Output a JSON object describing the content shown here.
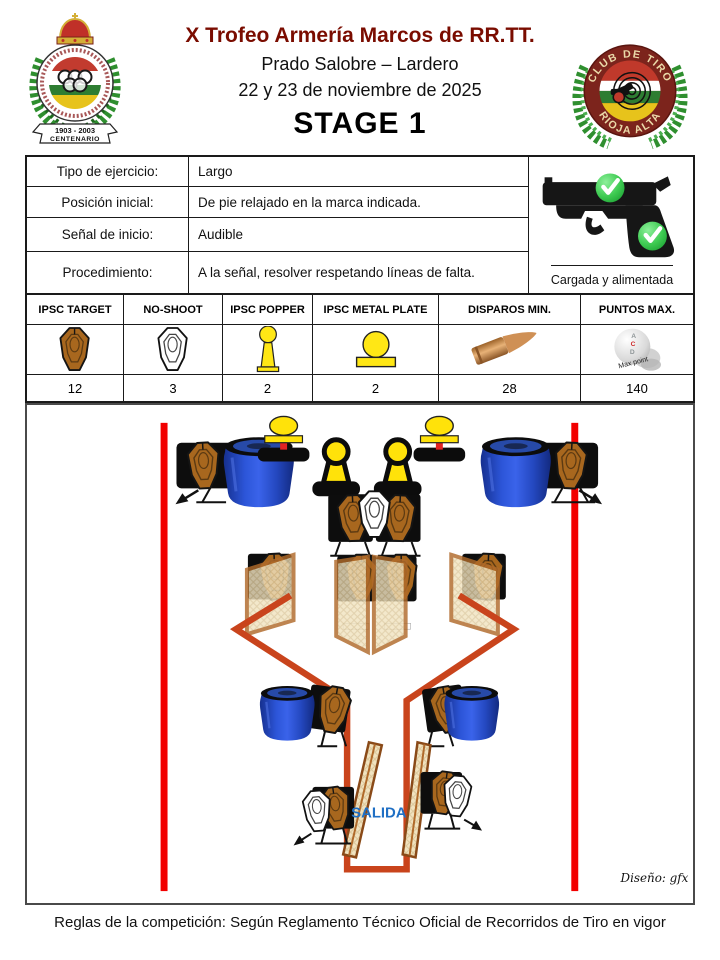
{
  "header": {
    "title": "X Trofeo Armería Marcos de RR.TT.",
    "subtitle1": "Prado Salobre – Lardero",
    "subtitle2": "22 y 23 de noviembre de 2025",
    "stage": "STAGE 1",
    "left_logo": {
      "banner_line1": "1903 - 2003",
      "banner_line2": "CENTENARIO"
    },
    "right_logo": {
      "top_text": "CLUB DE TIRO",
      "bottom_text": "RIOJA ALTA"
    }
  },
  "info_table": {
    "rows": [
      {
        "label": "Tipo de ejercicio:",
        "value": "Largo"
      },
      {
        "label": "Posición inicial:",
        "value": "De pie relajado en la marca indicada."
      },
      {
        "label": "Señal de inicio:",
        "value": "Audible"
      },
      {
        "label": "Procedimiento:",
        "value": "A la señal, resolver respetando líneas de falta."
      }
    ],
    "gun_caption": "Cargada y alimentada"
  },
  "targets_table": {
    "columns": [
      {
        "header": "IPSC TARGET",
        "value": "12"
      },
      {
        "header": "NO-SHOOT",
        "value": "3"
      },
      {
        "header": "IPSC POPPER",
        "value": "2"
      },
      {
        "header": "IPSC METAL PLATE",
        "value": "2"
      },
      {
        "header": "DISPAROS MIN.",
        "value": "28"
      },
      {
        "header": "PUNTOS MAX.",
        "value": "140"
      }
    ],
    "score_ball": {
      "letters": [
        "A",
        "C",
        "D"
      ],
      "label": "Max point"
    }
  },
  "diagram": {
    "salida_label": "SALIDA",
    "signature": "Diseño: gfx",
    "colors": {
      "fault_line": "#f20000",
      "rail": "#c9441c",
      "barrel_blue": "#2c55d8",
      "target_brown": "#a8671e",
      "popper_yellow": "#ffe20a",
      "wall_fill": "#f1e3c0",
      "wall_frame": "#b06a2a",
      "salida_blue": "#1f6fc4",
      "check_green": "#2fbf46",
      "title_maroon": "#7a0c00"
    }
  },
  "footer": {
    "rules": "Reglas de la competición: Según Reglamento Técnico Oficial de Recorridos de Tiro en vigor"
  }
}
